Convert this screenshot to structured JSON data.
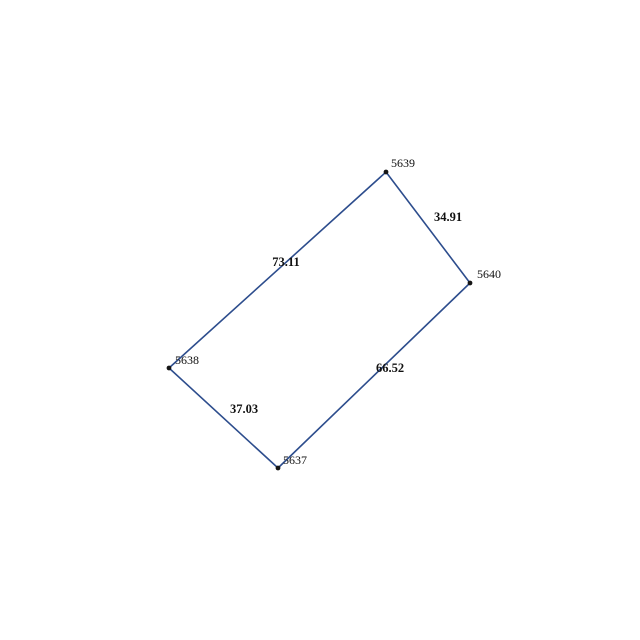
{
  "figure": {
    "type": "parcel-boundary-sketch",
    "background_color": "#ffffff",
    "line_color": "#2d4d8d",
    "point_color": "#151515",
    "label_color": "#111111",
    "vertices": [
      {
        "id": "5637",
        "x": 278,
        "y": 468,
        "label_x": 283,
        "label_y": 464
      },
      {
        "id": "5638",
        "x": 169,
        "y": 368,
        "label_x": 175,
        "label_y": 364
      },
      {
        "id": "5639",
        "x": 386,
        "y": 172,
        "label_x": 391,
        "label_y": 167
      },
      {
        "id": "5640",
        "x": 470,
        "y": 283,
        "label_x": 477,
        "label_y": 278
      }
    ],
    "edges": [
      {
        "from": "5637",
        "to": "5638",
        "length": "37.03",
        "label_x": 244,
        "label_y": 413
      },
      {
        "from": "5638",
        "to": "5639",
        "length": "73.11",
        "label_x": 286,
        "label_y": 266
      },
      {
        "from": "5639",
        "to": "5640",
        "length": "34.91",
        "label_x": 448,
        "label_y": 221
      },
      {
        "from": "5640",
        "to": "5637",
        "length": "66.52",
        "label_x": 390,
        "label_y": 372
      }
    ]
  }
}
